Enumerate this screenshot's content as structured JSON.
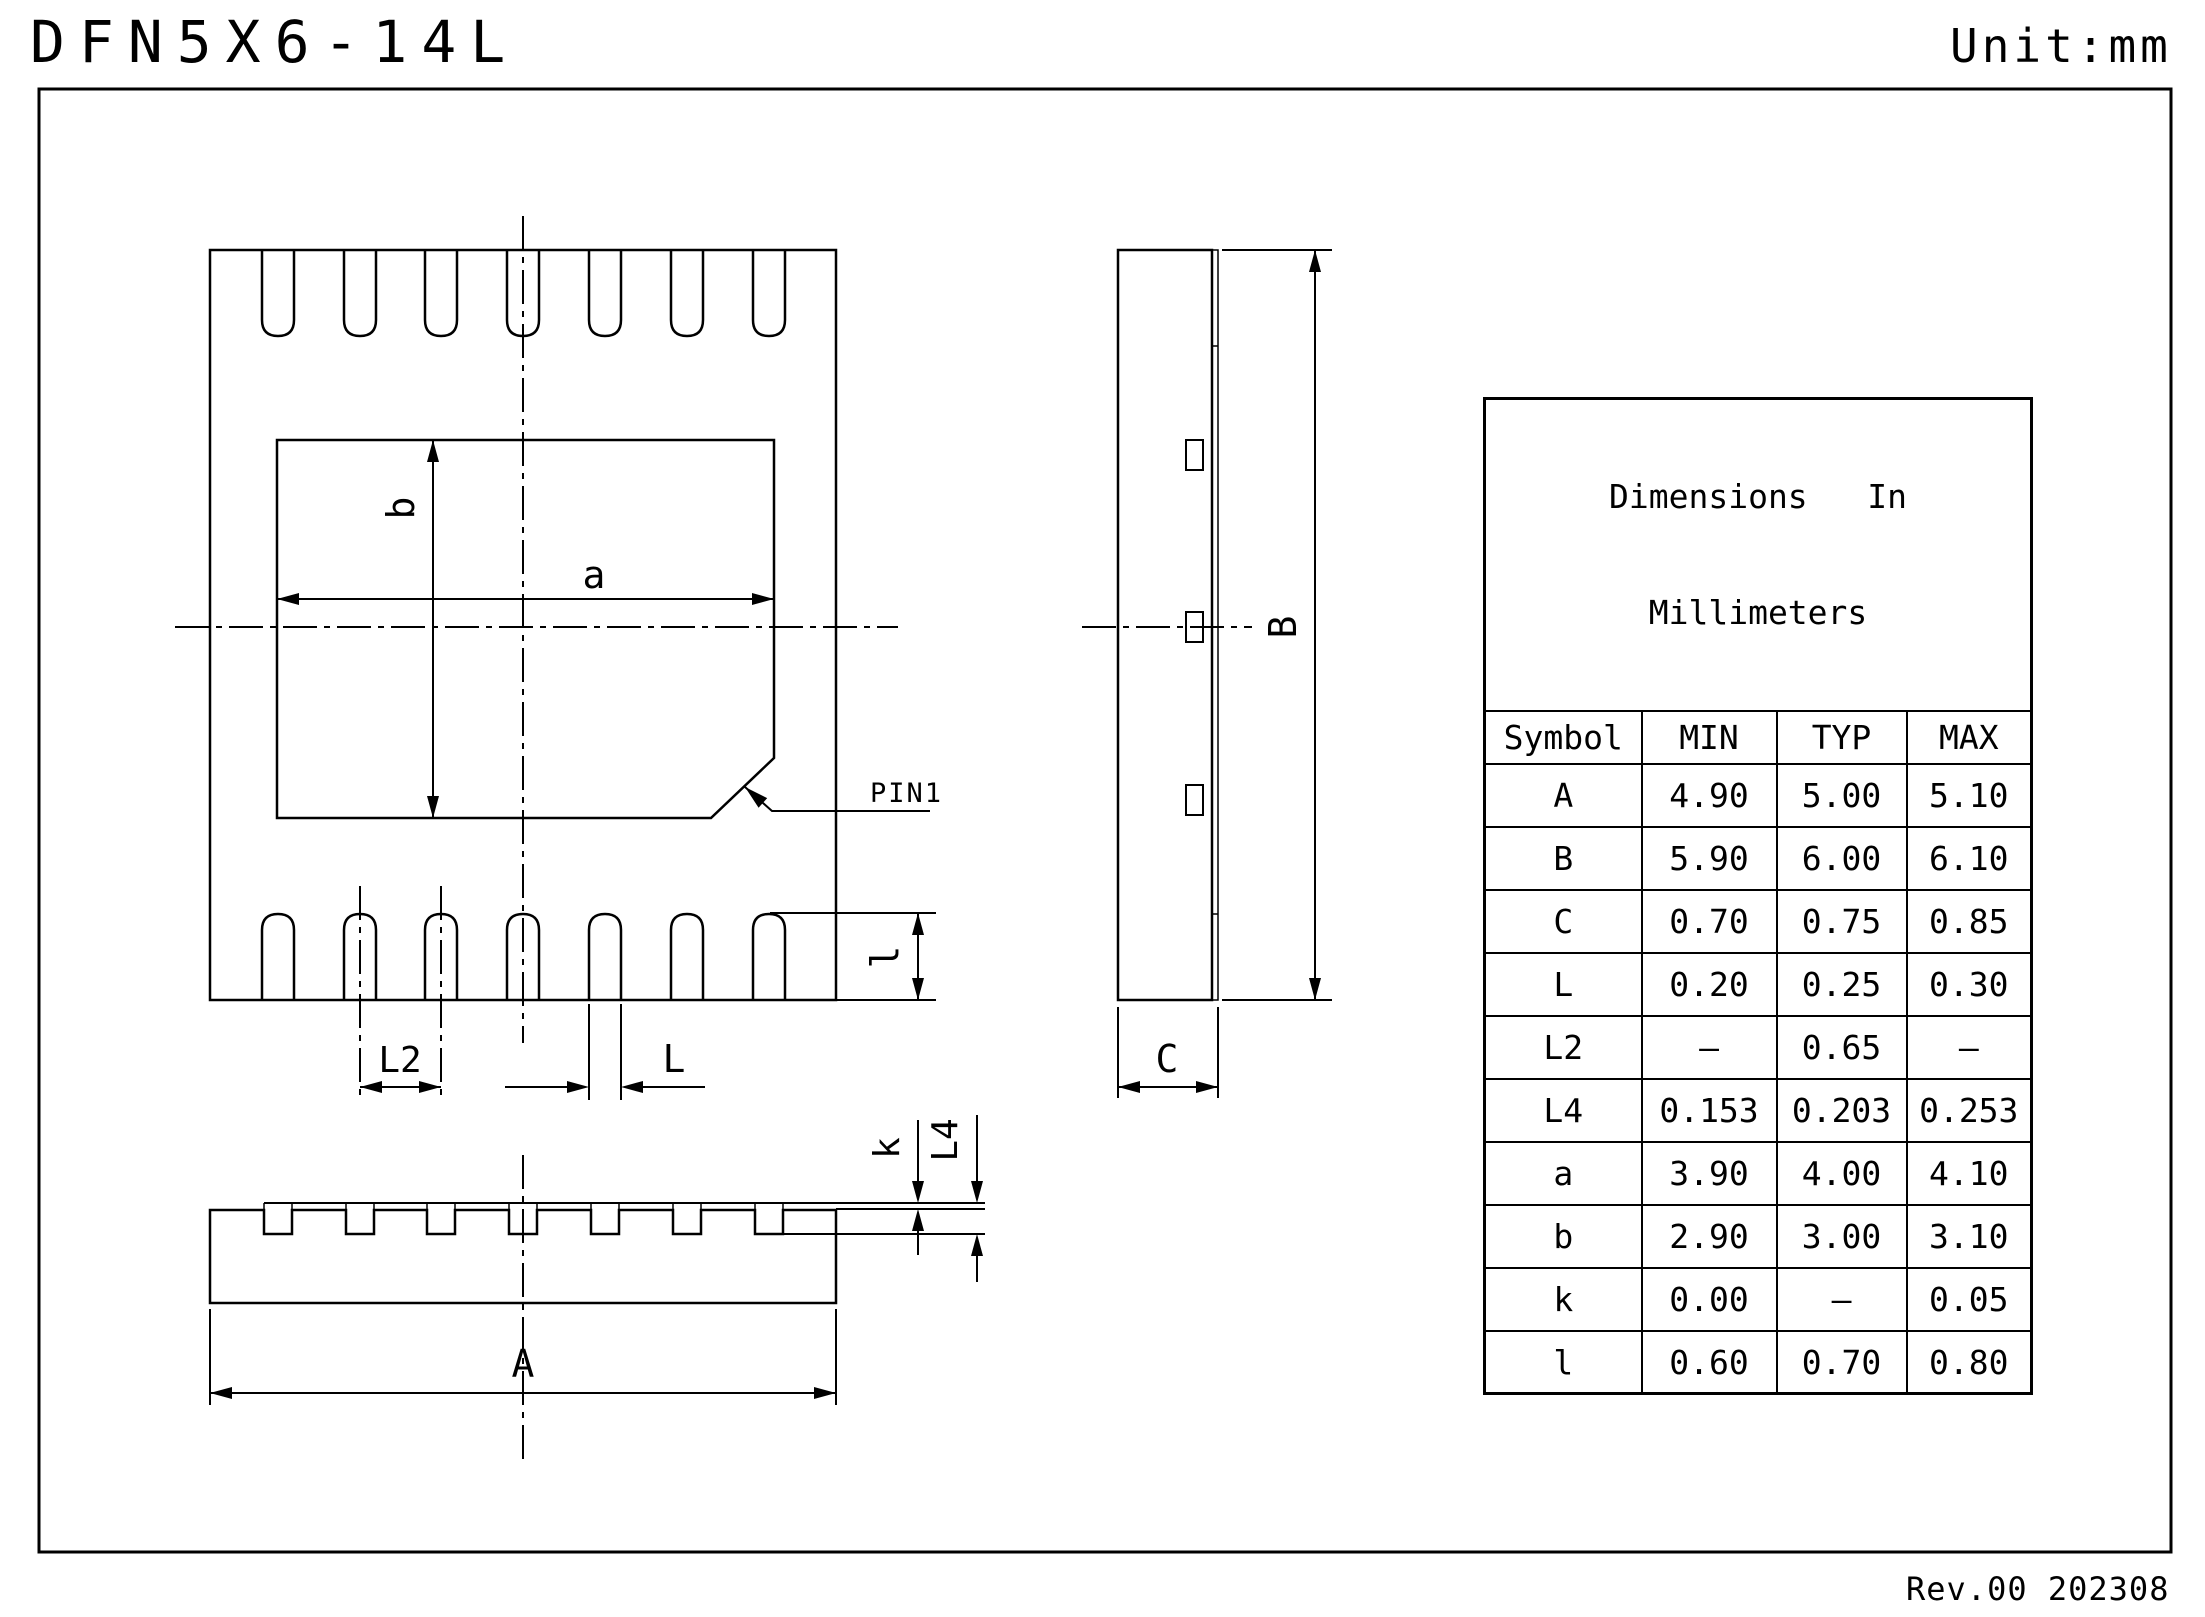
{
  "doc": {
    "title": "DFN5X6-14L",
    "unit": "Unit:mm",
    "revision": "Rev.00 202308"
  },
  "views": {
    "top": {
      "a": "a",
      "b": "b",
      "l2": "L2",
      "l_width": "L",
      "l_len": "l",
      "pin1": "PIN1"
    },
    "side": {
      "b": "B",
      "c": "C"
    },
    "front": {
      "a": "A",
      "k": "k",
      "l4": "L4"
    }
  },
  "table": {
    "title_line1": "Dimensions   In",
    "title_line2": "Millimeters",
    "headers": [
      "Symbol",
      "MIN",
      "TYP",
      "MAX"
    ],
    "rows": [
      {
        "symbol": "A",
        "min": "4.90",
        "typ": "5.00",
        "max": "5.10"
      },
      {
        "symbol": "B",
        "min": "5.90",
        "typ": "6.00",
        "max": "6.10"
      },
      {
        "symbol": "C",
        "min": "0.70",
        "typ": "0.75",
        "max": "0.85"
      },
      {
        "symbol": "L",
        "min": "0.20",
        "typ": "0.25",
        "max": "0.30"
      },
      {
        "symbol": "L2",
        "min": "–",
        "typ": "0.65",
        "max": "–"
      },
      {
        "symbol": "L4",
        "min": "0.153",
        "typ": "0.203",
        "max": "0.253"
      },
      {
        "symbol": "a",
        "min": "3.90",
        "typ": "4.00",
        "max": "4.10"
      },
      {
        "symbol": "b",
        "min": "2.90",
        "typ": "3.00",
        "max": "3.10"
      },
      {
        "symbol": "k",
        "min": "0.00",
        "typ": "–",
        "max": "0.05"
      },
      {
        "symbol": "l",
        "min": "0.60",
        "typ": "0.70",
        "max": "0.80"
      }
    ]
  },
  "colors": {
    "ink": "#000000",
    "paper": "#ffffff"
  }
}
